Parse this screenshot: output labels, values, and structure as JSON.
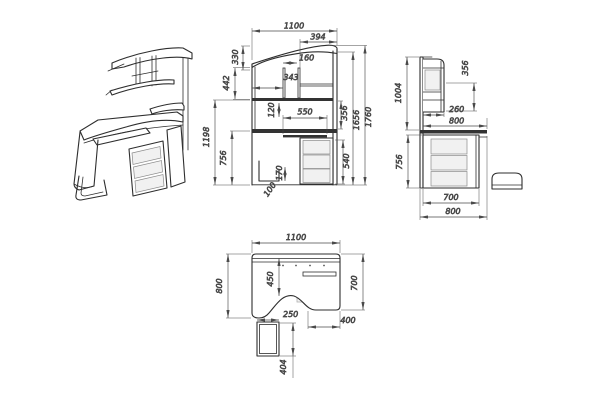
{
  "drawing": {
    "ink": "#2e2e2e",
    "dim_ink": "#4a4a4a",
    "views": {
      "isometric": {
        "name": "isometric view"
      },
      "front": {
        "name": "front view",
        "dims": {
          "w_overall": "1100",
          "w_right": "394",
          "h_roof": "330",
          "w_niche": "160",
          "w_mid": "343",
          "h_upper": "442",
          "h_gap": "120",
          "w_tray": "550",
          "h_lower_total": "1198",
          "h_pedestal": "756",
          "h_cpu": "170",
          "w_cpu": "100",
          "h_shelf": "356",
          "h_hutch": "1656",
          "h_overall": "1760",
          "h_drawers": "540"
        }
      },
      "side": {
        "name": "side view",
        "dims": {
          "h_shelf": "356",
          "h_upper": "1004",
          "d_shelf": "260",
          "d_top": "800",
          "h_pedestal": "756",
          "d_pedestal": "700",
          "d_overall": "800"
        }
      },
      "top": {
        "name": "top (plan) view",
        "dims": {
          "w_overall": "1100",
          "d_left": "800",
          "d_cutout": "450",
          "d_right": "700",
          "w_cpu": "250",
          "w_right": "400",
          "d_cpu": "404"
        }
      }
    }
  }
}
